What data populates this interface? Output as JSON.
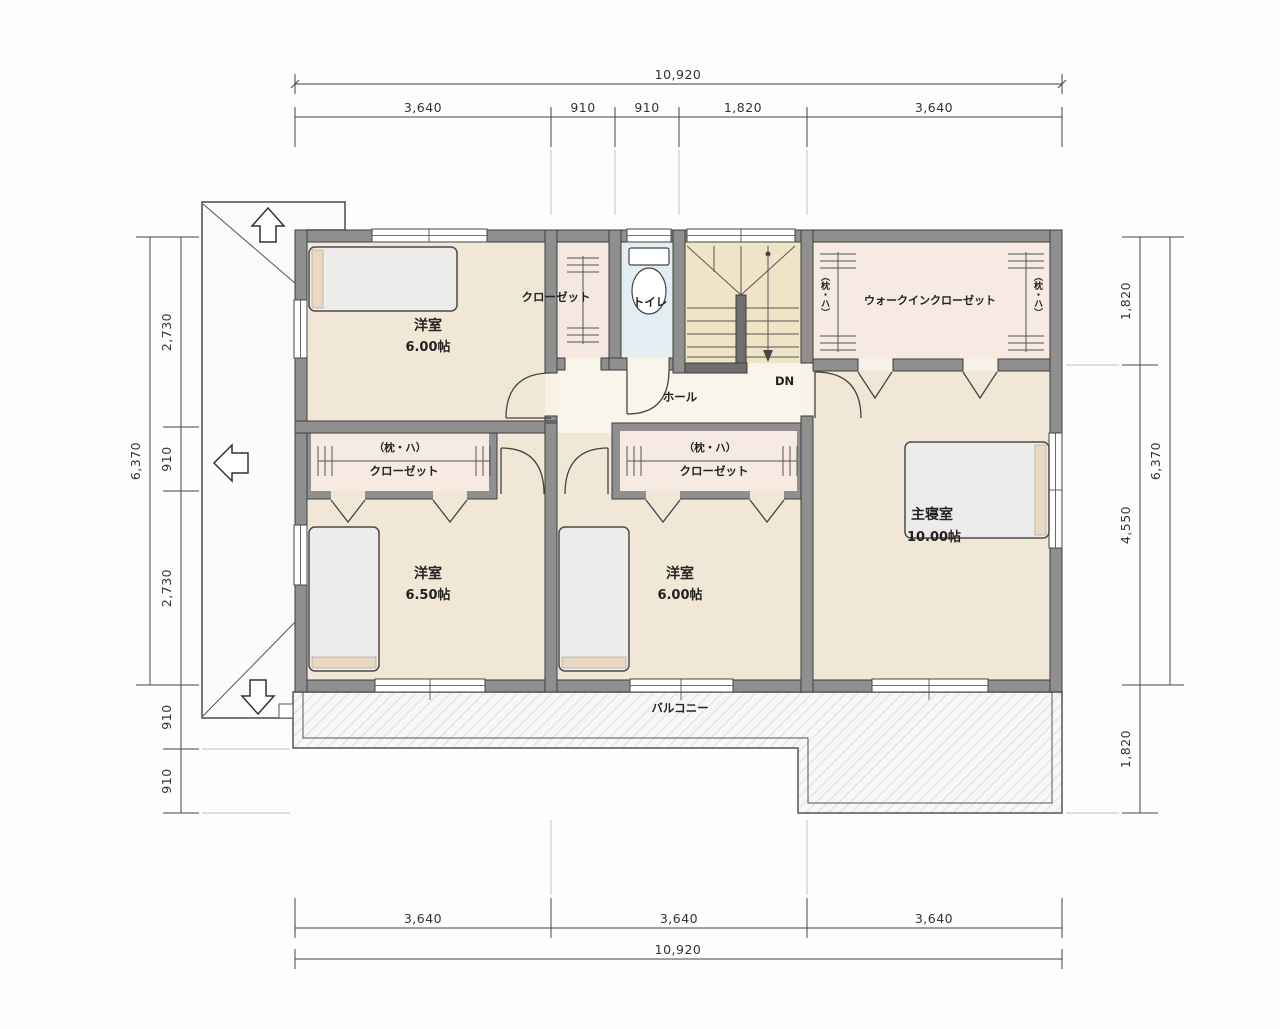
{
  "drawing": {
    "type": "floor-plan-2f",
    "dims": {
      "top_total": "10,920",
      "top_segs": [
        "3,640",
        "910",
        "910",
        "1,820",
        "3,640"
      ],
      "bottom_segs": [
        "3,640",
        "3,640",
        "3,640"
      ],
      "bottom_total": "10,920",
      "left_total": "6,370",
      "left_segs": [
        "2,730",
        "910",
        "2,730"
      ],
      "left_below": [
        "910",
        "910"
      ],
      "right_total": "6,370",
      "right_segs": [
        "1,820",
        "4,550"
      ],
      "right_below": [
        "1,820"
      ]
    },
    "rooms": {
      "bedroom_top_left": {
        "name": "洋室",
        "size": "6.00帖"
      },
      "closet_top": {
        "name": "クローゼット"
      },
      "toilet": {
        "name": "トイレ"
      },
      "hall": {
        "name": "ホール"
      },
      "stairs": {
        "down_label": "DN"
      },
      "wic": {
        "name": "ウォークインクローゼット",
        "shelf_note": "（枕・ハ）"
      },
      "closet_a": {
        "shelf_note": "（枕・ハ）",
        "name": "クローゼット"
      },
      "closet_b": {
        "shelf_note": "（枕・ハ）",
        "name": "クローゼット"
      },
      "bedroom_bottom_left": {
        "name": "洋室",
        "size": "6.50帖"
      },
      "bedroom_bottom_mid": {
        "name": "洋室",
        "size": "6.00帖"
      },
      "master_bedroom": {
        "name": "主寝室",
        "size": "10.00帖"
      },
      "balcony": {
        "name": "バルコニー"
      }
    },
    "colors": {
      "wall": "#8f8f8f",
      "room_floor": "#f1e7d6",
      "closet_floor": "#f6eae2",
      "toilet_floor": "#e2eef1",
      "stair_floor": "#efe4c6",
      "hall_floor": "#faf5eb",
      "balcony_floor": "#f7f7f5",
      "line": "#3c3c3c"
    }
  }
}
